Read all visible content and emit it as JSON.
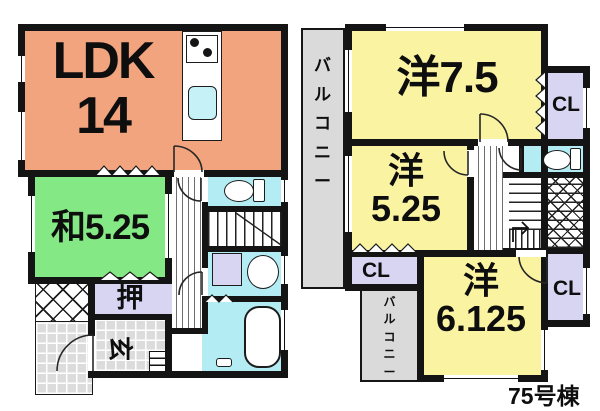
{
  "building_label": "75号棟",
  "floor1": {
    "ldk_label": "LDK",
    "ldk_size": "14",
    "washitsu_label": "和5.25",
    "oshiire_label": "押",
    "genkan_label": "玄"
  },
  "floor2": {
    "room1_label": "洋7.5",
    "room2_kanji": "洋",
    "room2_size": "5.25",
    "room3_kanji": "洋",
    "room3_size": "6.125",
    "cl_top": "CL",
    "cl_mid": "CL",
    "cl_bottom": "CL",
    "balcony_left": "バルコニー",
    "balcony_bottom": "バルコニー"
  },
  "colors": {
    "ldk": "#F2A47E",
    "tatami": "#84E884",
    "western": "#F9F3A2",
    "closet": "#D8D5F2",
    "wet": "#B4ECF4",
    "balcony": "#DADADA",
    "wall": "#141414",
    "sink": "#C6F1F7"
  },
  "icons": {
    "stove-icon": "two black burner circles",
    "kitchen-sink-icon": "cyan rounded rect",
    "toilet-icon": "ellipse bowl + tank",
    "washing-machine-icon": "lavender square",
    "washbasin-icon": "oval basin",
    "bathtub-icon": "rounded rect tub",
    "door-arc-icon": "quarter-circle swing",
    "stairs-icon": "tread lines with hatch"
  }
}
